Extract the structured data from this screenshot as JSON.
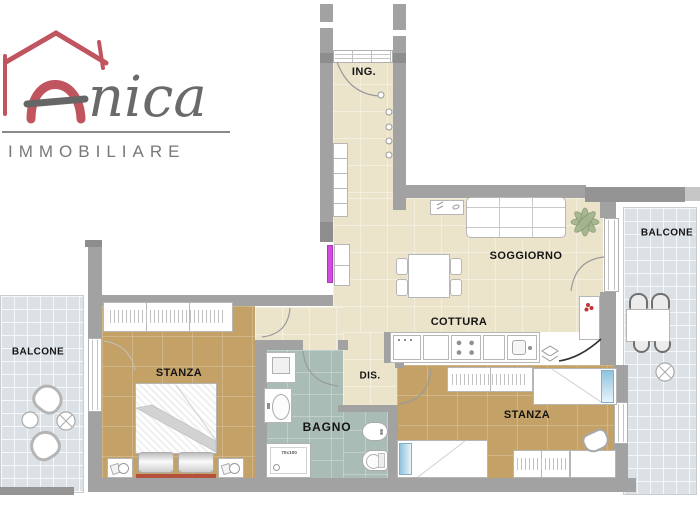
{
  "brand": {
    "accent_letter": "A",
    "name_script": "nica",
    "subtitle": "IMMOBILIARE"
  },
  "rooms": {
    "entry": {
      "label": "ING."
    },
    "living": {
      "label": "SOGGIORNO"
    },
    "kitchen": {
      "label": "COTTURA"
    },
    "hallway": {
      "label": "DIS."
    },
    "bathroom": {
      "label": "BAGNO"
    },
    "bedroom_left": {
      "label": "STANZA"
    },
    "bedroom_right": {
      "label": "STANZA"
    },
    "balcony_left": {
      "label": "BALCONE"
    },
    "balcony_right": {
      "label": "BALCONE"
    }
  },
  "annotations": {
    "shower_size": "70x100"
  },
  "colors": {
    "logo_red": "#c0545f",
    "logo_gray": "#6a6a6a",
    "wall_gray": "#a2a2a2",
    "floor_beige": "#ece4ca",
    "floor_wood_tan": "#c3a167",
    "floor_bath_teal": "#a9bcb6",
    "floor_tile_gray": "#dce1e5",
    "radiator_magenta": "#d24ae0",
    "pillow_blue": "#8fc3de",
    "headboard_red": "#b4503c"
  }
}
